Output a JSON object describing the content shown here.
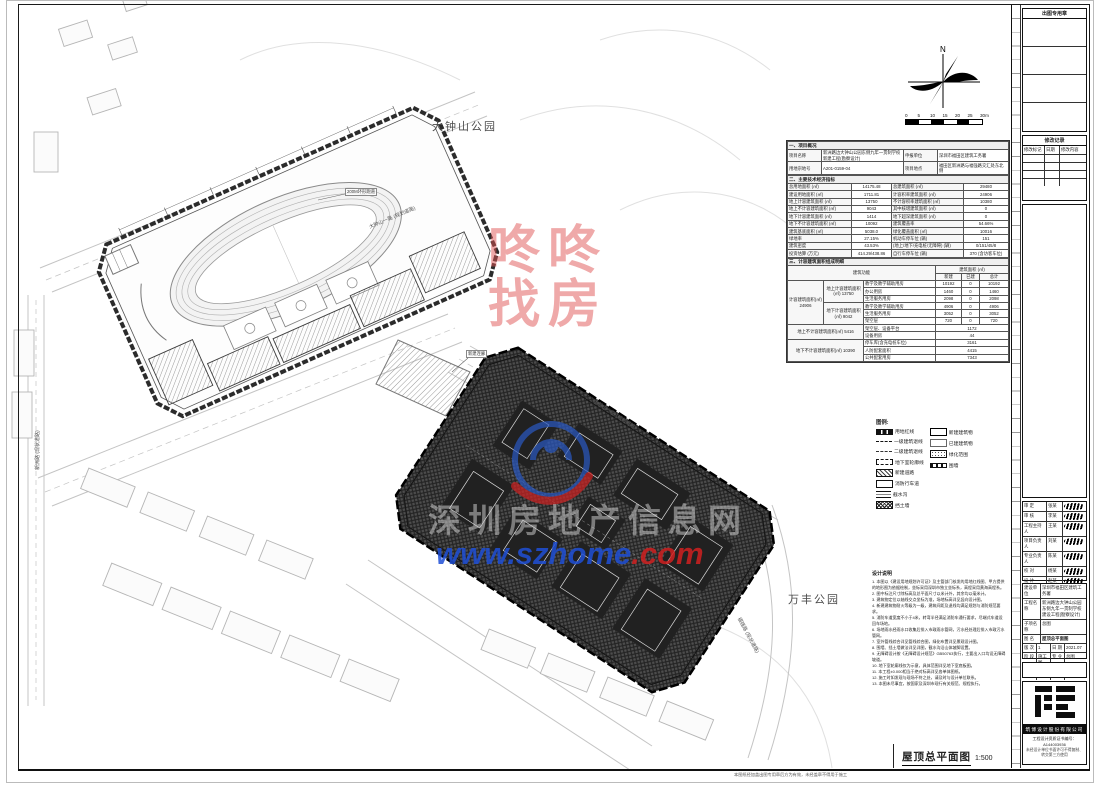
{
  "sheet": {
    "drawing_title": "屋顶总平面图",
    "drawing_scale": "1:500",
    "bottom_note": "本图纸经加盖出图专用章后方为有效，未经盖章不得用于施工",
    "north_label": "N",
    "scale_bar": [
      "0",
      "5",
      "10",
      "15",
      "20",
      "25",
      "30m"
    ]
  },
  "map": {
    "park_top": "大钟山公园",
    "park_right": "万丰公园",
    "road_labels": [
      "大钟山一路 (规划道路)",
      "大钟山一路 (规划道路)",
      "新洲路 (现状道路)",
      "福强路 (现状道路)"
    ],
    "callouts": [
      "200M环形跑道",
      "新建连廊"
    ]
  },
  "watermarks": {
    "red_line1": "咚咚",
    "red_line2": "找房",
    "gray_text": "深圳房地产信息网",
    "url_blue": "www.szhome",
    "url_red": ".com",
    "red_color": "#e05353",
    "blue_color": "#1e4fd6"
  },
  "info_table": {
    "section1_title": "一、项目概况",
    "s1_rows": [
      [
        "项目名称",
        "新洲路边大钟山公园东侧九年一贯制学校新建工程(勘察设计)",
        "申报单位",
        "深圳市福田区建筑工务署"
      ],
      [
        "用地宗地号",
        "A201-0159-04",
        "项目地点",
        "福田区新洲路与福强路交汇处东北侧"
      ]
    ],
    "section2_title": "二、主要技术经济指标",
    "s2_rows": [
      [
        "总用地面积 (㎡)",
        "14175.48",
        "总建筑面积 (㎡)",
        "29480"
      ],
      [
        "建设用地面积 (㎡)",
        "1711.81",
        "计容积率建筑面积 (㎡)",
        "24906"
      ],
      [
        "地上计容建筑面积 (㎡)",
        "13750",
        "不计容积率建筑面积 (㎡)",
        "10380"
      ],
      [
        "地上不计容建筑面积 (㎡)",
        "9043",
        "其中核增建筑面积 (㎡)",
        "0"
      ],
      [
        "地下计容建筑面积 (㎡)",
        "1414",
        "地下超深建筑面积 (㎡)",
        "0"
      ],
      [
        "地下不计容建筑面积 (㎡)",
        "10092",
        "建筑覆盖率",
        "54.66%"
      ],
      [
        "建筑基底面积 (㎡)",
        "5038.0",
        "绿化覆盖面积 (㎡)",
        "10016"
      ],
      [
        "绿地率",
        "27.15%",
        "机动车停车位 (辆)",
        "151"
      ],
      [
        "建筑密度",
        "43.53%",
        "(地上/地下/充电桩/无障碍) (辆)",
        "0/151/45/8"
      ],
      [
        "投资估算 (万元)",
        "414.29/438.86",
        "自行车停车位 (辆)",
        "370 (含访客车位)"
      ]
    ],
    "section3_title": "三、计容建筑面积组成明细",
    "s3_head": [
      "建筑功能",
      "建筑面积 (㎡)",
      "新建",
      "已建",
      "总计"
    ],
    "s3_group1": "计容建筑面积(㎡) 24906",
    "s3_sub1": "地上计容建筑面积(㎡) 13750",
    "s3_sub2": "地下计容建筑面积(㎡) 9042",
    "s3_rows_a": [
      [
        "教学及教学辅助用房",
        "10192",
        "0",
        "10192"
      ],
      [
        "办公用房",
        "1460",
        "0",
        "1460"
      ],
      [
        "生活服务用房",
        "2098",
        "0",
        "2098"
      ]
    ],
    "s3_rows_b": [
      [
        "教学及教学辅助用房",
        "4906",
        "0",
        "4906"
      ],
      [
        "生活服务用房",
        "3052",
        "0",
        "3052"
      ],
      [
        "架空层",
        "720",
        "0",
        "720"
      ]
    ],
    "s3_groupc": "地上不计容建筑面积(㎡) 5416",
    "s3_rows_c": [
      [
        "架空层、设备平台",
        "1172"
      ],
      [
        "设备用房",
        "44"
      ]
    ],
    "s3_groupd": "地下不计容建筑面积(㎡) 10390",
    "s3_rows_d": [
      [
        "停车库(含充电桩车位)",
        "3161"
      ],
      [
        "人防配套面积",
        "4415"
      ],
      [
        "公共配套用房",
        "7343"
      ]
    ]
  },
  "legend": {
    "title": "图例:",
    "left": [
      {
        "label": "用地红线",
        "swatch": "redline-swatch"
      },
      {
        "label": "一级建筑退线",
        "swatch": "dashdot-line-swatch"
      },
      {
        "label": "二级建筑退线",
        "swatch": "dashdot2-line-swatch"
      },
      {
        "label": "地下室轮廓线",
        "swatch": "dashed-line-swatch"
      },
      {
        "label": "新建道路",
        "swatch": "hatch-swatch"
      },
      {
        "label": "消防行车道",
        "swatch": "outline-swatch"
      },
      {
        "label": "截水沟",
        "swatch": "double-line-swatch"
      },
      {
        "label": "挡土墙",
        "swatch": "crosshatch-swatch"
      }
    ],
    "right": [
      {
        "label": "新建建筑物",
        "swatch": "bold-outline-swatch"
      },
      {
        "label": "已建建筑物",
        "swatch": "thin-outline-swatch"
      },
      {
        "label": "绿化范围",
        "swatch": "stipple-swatch"
      },
      {
        "label": "围墙",
        "swatch": "wall-swatch"
      }
    ]
  },
  "notes": {
    "title": "设计说明",
    "items": [
      "1. 本图以《建设用地规划许可证》及主管部门核发的用地红线图、甲方提供的地形图为依据绘制，坐标采用深圳市独立坐标系，高程采用黄海高程系。",
      "2. 图中标注尺寸除标高及总平面尺寸以米计外，其余均以毫米计。",
      "3. 建筑物定位以轴线交点坐标为准，场地标高详见竖向设计图。",
      "4. 新建建筑物耐火等级为一级，建筑间距及退线均满足规划与消防规范要求。",
      "5. 消防车道宽度不小于4米，转弯半径满足消防车通行要求，尽端式车道设回车场地。",
      "6. 场地雨水经雨水口收集后排入市政雨水管网，污水经处理后排入市政污水管网。",
      "7. 室外管线综合详见管线综合图，绿化布置详见景观设计图。",
      "8. 围墙、挡土墙做法详见详图，截水沟沿山体坡脚设置。",
      "9. 无障碍设计按《无障碍设计规范》GB50763执行，主要出入口均设无障碍坡道。",
      "10. 地下室轮廓线仅为示意，具体范围详见地下室底板图。",
      "11. 本工程±0.000相当于绝对标高详见各单体图纸。",
      "12. 施工时如发现与现场不符之处，请及时与设计单位联系。",
      "13. 本图未尽事宜，按国家及深圳市现行有关规范、规程执行。"
    ]
  },
  "titleblock": {
    "seal_box_title": "出图专用章",
    "revision_title": "修改记录",
    "revision_cols": [
      "修改标记",
      "日期",
      "修改内容"
    ],
    "sig_rows": [
      {
        "role": "审 定",
        "name": "张某"
      },
      {
        "role": "审 核",
        "name": "李某"
      },
      {
        "role": "工程主持人",
        "name": "王某"
      },
      {
        "role": "项目负责人",
        "name": "刘某"
      },
      {
        "role": "专业负责人",
        "name": "陈某"
      },
      {
        "role": "校 对",
        "name": "杨某"
      },
      {
        "role": "设 计",
        "name": "赵某"
      }
    ],
    "proj_rows": [
      {
        "label": "建设单位",
        "value": "深圳市福田区建筑工务署"
      },
      {
        "label": "工程名称",
        "value": "新洲路边大钟山公园东侧九年一贯制学校建设工程(勘察设计)"
      },
      {
        "label": "子项名称",
        "value": "总图"
      },
      {
        "label": "图  名",
        "value": "屋顶总平面图"
      }
    ],
    "meta_rows": [
      [
        "版 次",
        "1",
        "日 期",
        "2021.07"
      ],
      [
        "阶 段",
        "施工图",
        "专 业",
        "总图"
      ],
      [
        "比 例",
        "1:500",
        "图 号",
        "JS-024-T001"
      ]
    ],
    "company": "筑博设计股份有限公司",
    "cert_line": "工程设计资质证书编号：A144003936",
    "copy_line": "未经设计单位书面许可不得复制、转交第三方使用"
  }
}
